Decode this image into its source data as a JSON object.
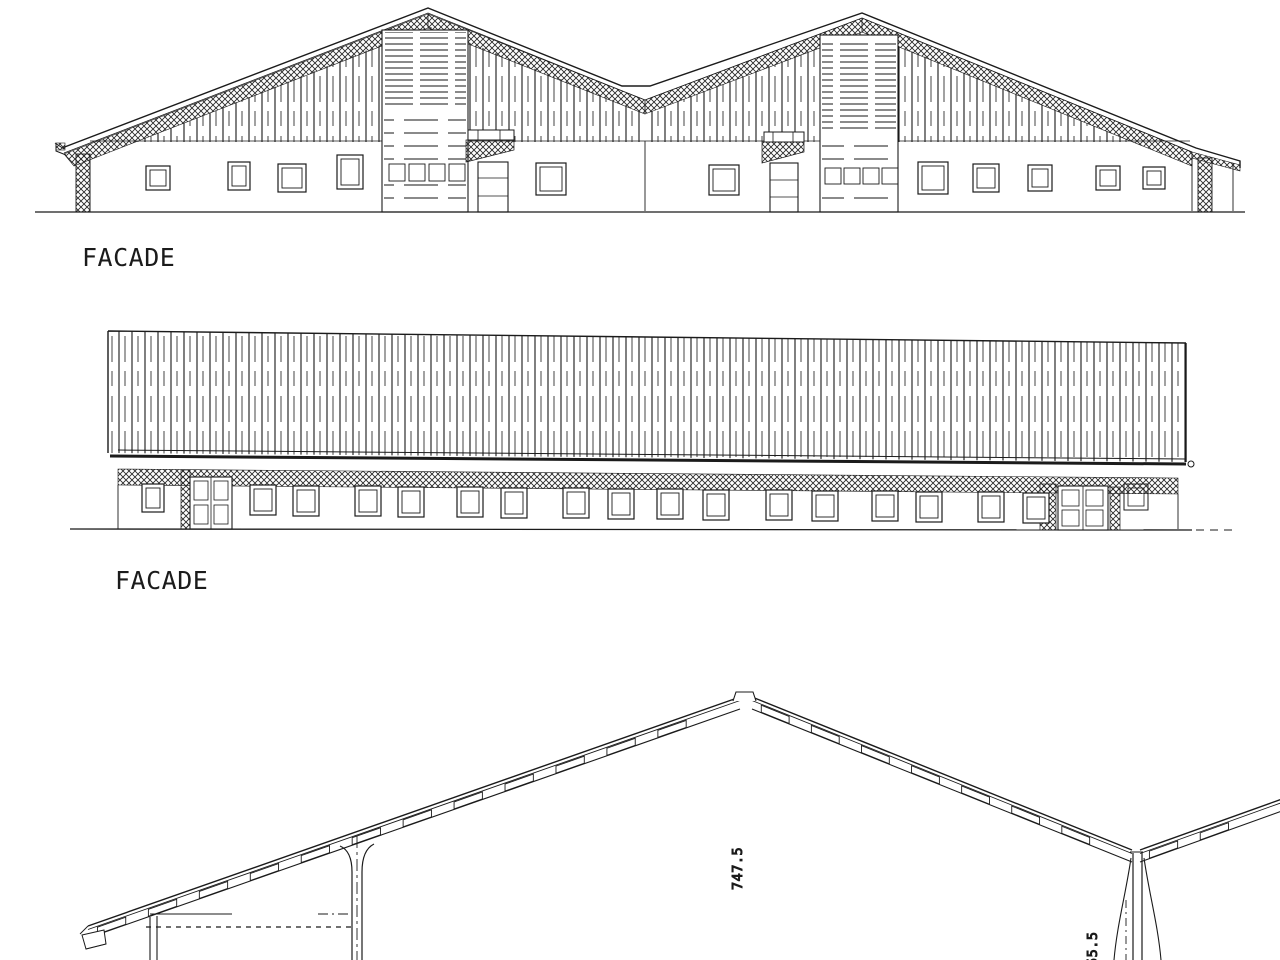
{
  "page": {
    "background_color": "#ffffff",
    "ink_color": "#1b1b1b",
    "description": "Architectural elevation drawings of a farm building"
  },
  "views": [
    {
      "id": "facade-front-elevation",
      "label": "FACADE",
      "type": "front elevation, double gable barn"
    },
    {
      "id": "facade-side-elevation",
      "label": "FACADE",
      "type": "long side elevation with window row"
    },
    {
      "id": "roof-cross-section",
      "type": "partial roof cross-section",
      "annotations": [
        {
          "text": "747.5",
          "orientation": "rotated-90"
        },
        {
          "text": "55.5",
          "orientation": "rotated-90",
          "note": "clipped at bottom edge"
        }
      ]
    }
  ]
}
